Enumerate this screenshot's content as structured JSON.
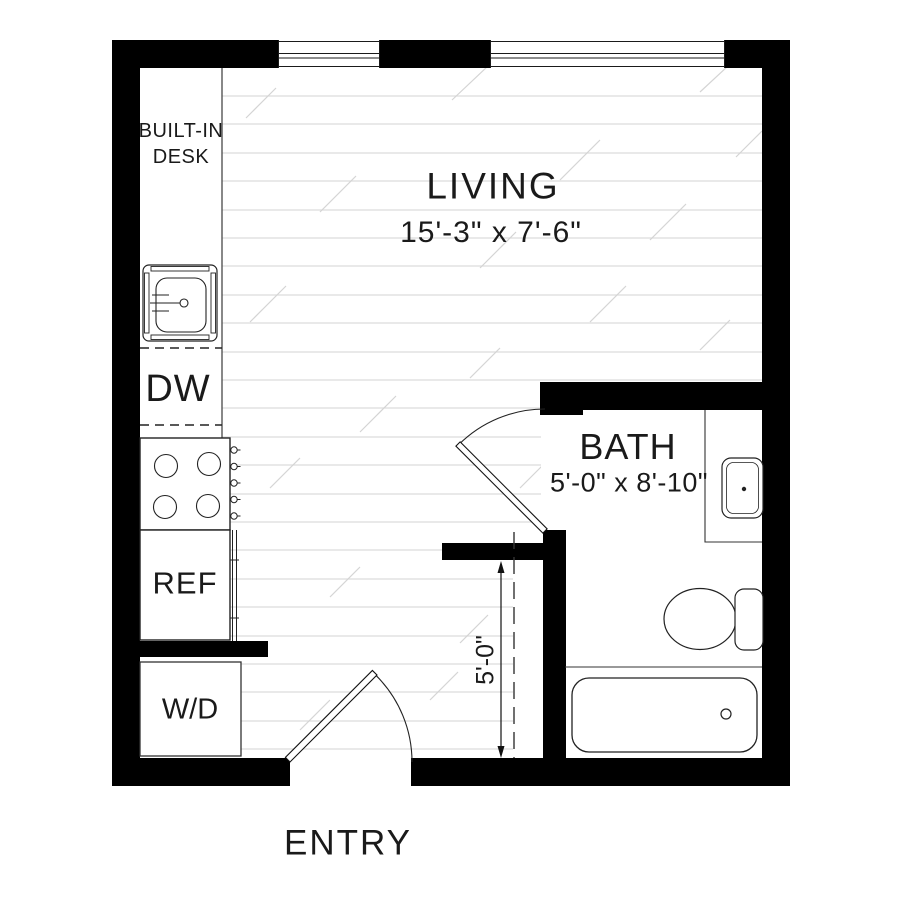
{
  "title": "Studio apartment floor plan",
  "rooms": {
    "living": {
      "label": "LIVING",
      "dimensions": "15'-3\" x 7'-6\""
    },
    "bath": {
      "label": "BATH",
      "dimensions": "5'-0\" x 8'-10\""
    }
  },
  "fixtures": {
    "built_in_desk_line1": "BUILT-IN",
    "built_in_desk_line2": "DESK",
    "dishwasher": "DW",
    "refrigerator": "REF",
    "washer_dryer": "W/D"
  },
  "entry_label": "ENTRY",
  "dimension_annotation": {
    "value": "5'-0\""
  },
  "colors": {
    "wall": "#000000",
    "line": "#1a1a1a",
    "hatch": "#dcdcdc",
    "text": "#1a1a1a",
    "background": "#ffffff"
  }
}
